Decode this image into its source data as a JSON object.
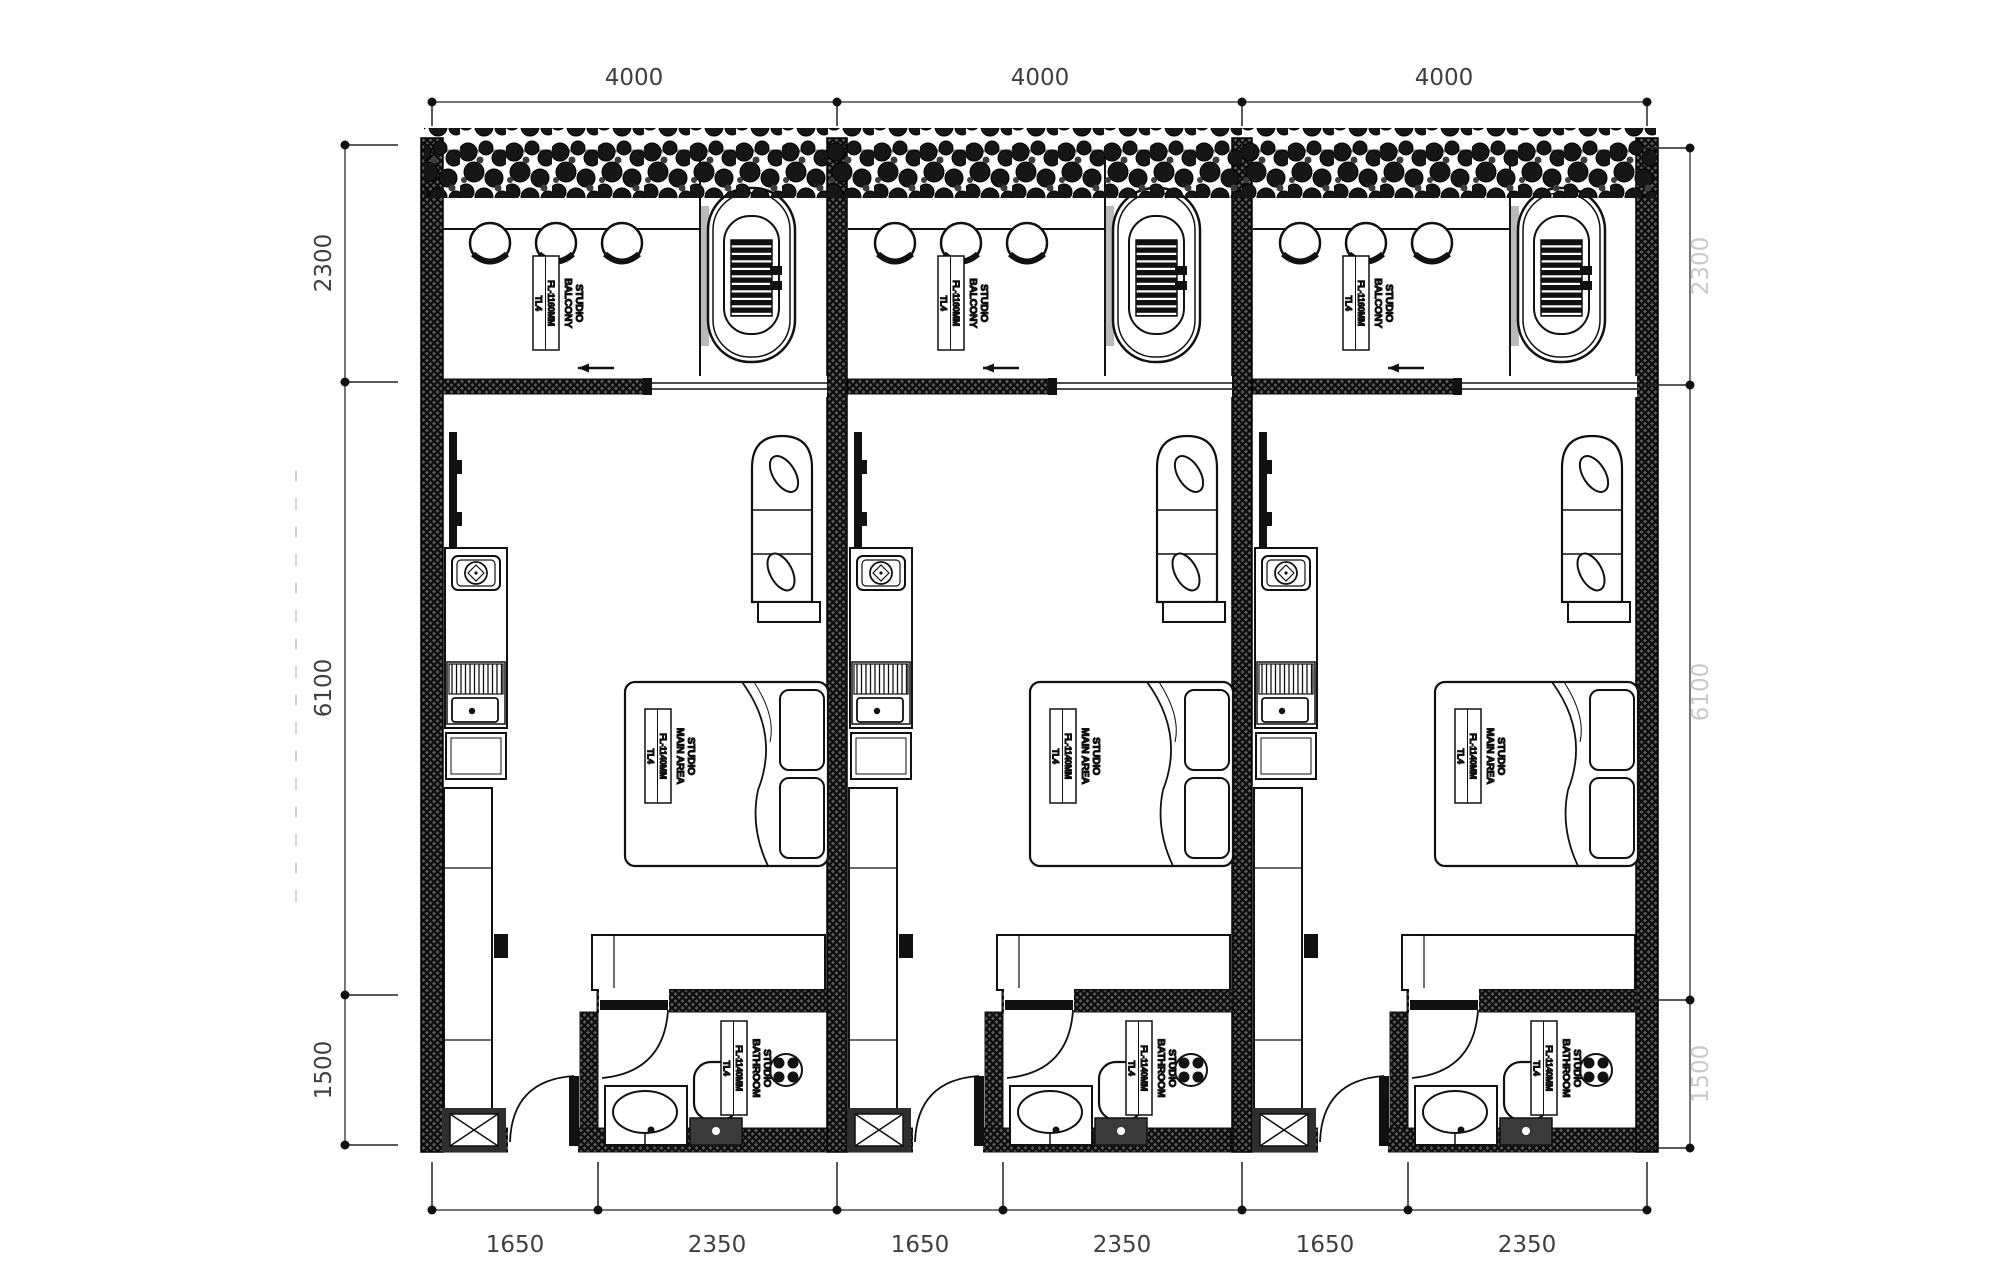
{
  "drawing": {
    "kind": "architectural floor plan",
    "units_visible": 3
  },
  "dimensions": {
    "top": [
      "4000",
      "4000",
      "4000"
    ],
    "bottom": [
      "1650",
      "2350",
      "1650",
      "2350",
      "1650",
      "2350"
    ],
    "left": [
      "2300",
      "6100",
      "1500"
    ],
    "right": [
      "2300",
      "6100",
      "1500"
    ]
  },
  "unit_labels": {
    "balcony": {
      "line1": "STUDIO",
      "line2": "BALCONY",
      "level": "FL-1160MM",
      "tag": "TL4"
    },
    "main": {
      "line1": "STUDIO",
      "line2": "MAIN AREA",
      "level": "FL-1140MM",
      "tag": "TL4"
    },
    "bathroom": {
      "line1": "STUDIO",
      "line2": "BATHROOM",
      "level": "FL-1140MM",
      "tag": "TL4"
    }
  },
  "colors": {
    "ink": "#111111",
    "wall_fill": "#4f4f4f",
    "dim_line": "#777777",
    "dim_text": "#3f3f3f",
    "faint_text": "#c9c9c9",
    "rail": "#8a8a8a",
    "paper": "#ffffff"
  }
}
